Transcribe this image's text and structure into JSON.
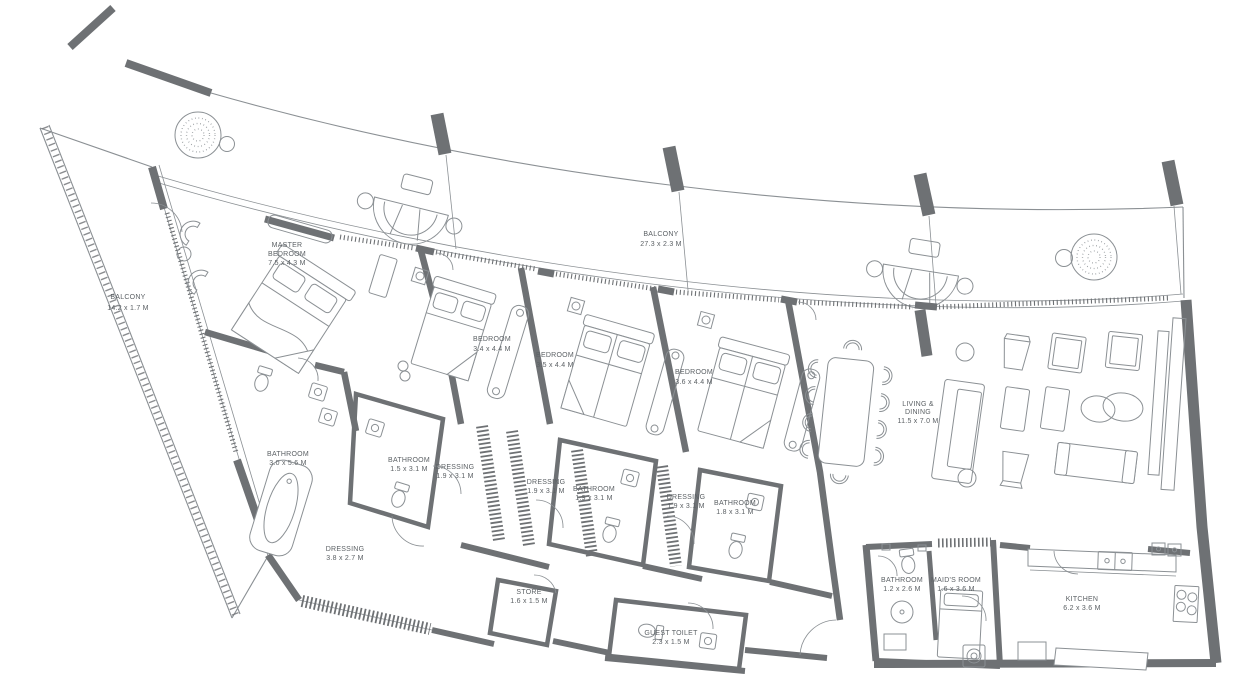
{
  "drawing": {
    "background": "#ffffff",
    "ink": "#8b9094",
    "wall": "#6e7174",
    "text": "#5c6165"
  },
  "rooms": [
    {
      "id": "balcony-left",
      "lines": [
        "BALCONY",
        "14.2 x 1.7 M"
      ]
    },
    {
      "id": "master-bedroom",
      "lines": [
        "MASTER",
        "BEDROOM",
        "7.5 x 4.3 M"
      ]
    },
    {
      "id": "balcony-top",
      "lines": [
        "BALCONY",
        "27.3 x 2.3 M"
      ]
    },
    {
      "id": "bedroom-2",
      "lines": [
        "BEDROOM",
        "3.4 x 4.4 M"
      ]
    },
    {
      "id": "bedroom-3",
      "lines": [
        "BEDROOM",
        "3.5 x 4.4 M"
      ]
    },
    {
      "id": "bedroom-4",
      "lines": [
        "BEDROOM",
        "3.6 x 4.4 M"
      ]
    },
    {
      "id": "living-dining",
      "lines": [
        "LIVING &",
        "DINING",
        "11.5 x 7.0 M"
      ]
    },
    {
      "id": "master-bathroom",
      "lines": [
        "BATHROOM",
        "3.0 x 5.6 M"
      ]
    },
    {
      "id": "bathroom-2",
      "lines": [
        "BATHROOM",
        "1.5 x 3.1 M"
      ]
    },
    {
      "id": "dressing-2",
      "lines": [
        "DRESSING",
        "1.9 x 3.1 M"
      ]
    },
    {
      "id": "dressing-3",
      "lines": [
        "DRESSING",
        "1.9 x 3.1 M"
      ]
    },
    {
      "id": "bathroom-3",
      "lines": [
        "BATHROOM",
        "1.9 x 3.1 M"
      ]
    },
    {
      "id": "dressing-4",
      "lines": [
        "DRESSING",
        "1.9 x 3.1 M"
      ]
    },
    {
      "id": "bathroom-4",
      "lines": [
        "BATHROOM",
        "1.8 x 3.1 M"
      ]
    },
    {
      "id": "master-dressing",
      "lines": [
        "DRESSING",
        "3.8 x 2.7 M"
      ]
    },
    {
      "id": "store",
      "lines": [
        "STORE",
        "1.6 x 1.5 M"
      ]
    },
    {
      "id": "guest-toilet",
      "lines": [
        "GUEST TOILET",
        "2.3 x 1.5 M"
      ]
    },
    {
      "id": "maid-bathroom",
      "lines": [
        "BATHROOM",
        "1.2 x 2.6 M"
      ]
    },
    {
      "id": "maids-room",
      "lines": [
        "MAID'S ROOM",
        "1.6 x 3.6 M"
      ]
    },
    {
      "id": "kitchen",
      "lines": [
        "KITCHEN",
        "6.2 x 3.6 M"
      ]
    }
  ]
}
